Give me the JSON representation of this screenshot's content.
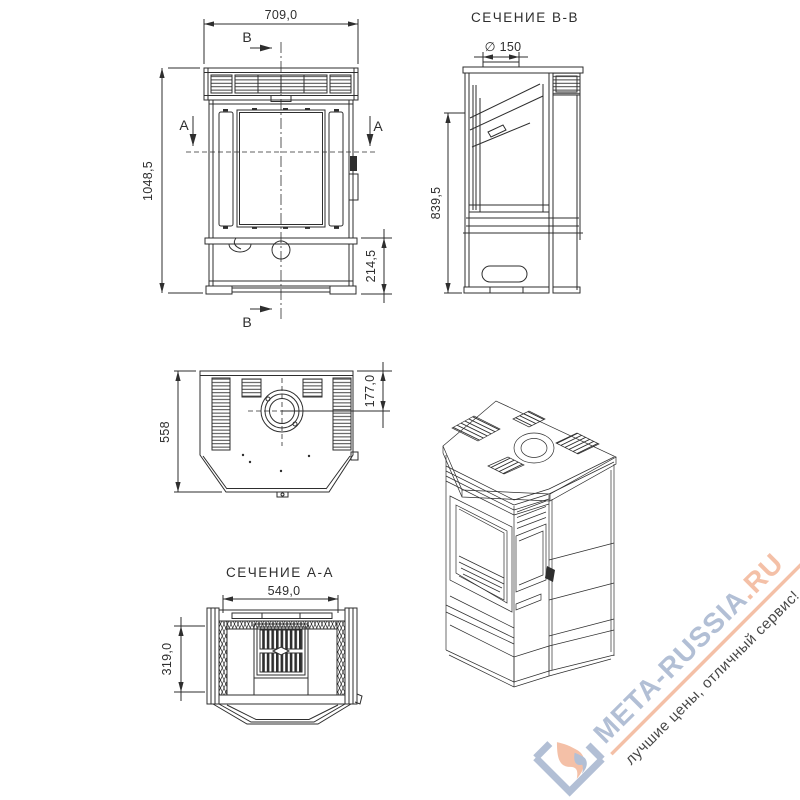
{
  "drawing": {
    "line_color": "#2e2e2e",
    "front_view": {
      "width_dim": "709,0",
      "height_dim": "1048,5",
      "base_height_dim": "214,5",
      "cut_label_a": "A",
      "cut_label_b": "B"
    },
    "section_bb": {
      "title": "СЕЧЕНИЕ В-В",
      "flue_diameter_dim": "∅ 150",
      "height_dim": "839,5"
    },
    "top_view": {
      "depth_dim": "558",
      "flue_offset_dim": "177,0"
    },
    "section_aa": {
      "title": "СЕЧЕНИЕ А-А",
      "width_dim": "549,0",
      "depth_dim": "319,0"
    }
  },
  "watermark": {
    "brand_main": "МЕТА-RUSSIA",
    "brand_tld": ".RU",
    "tagline": "лучшие цены, отличный сервис!",
    "color_blue": "#a8b7d0",
    "color_salmon": "#f3b89b"
  }
}
